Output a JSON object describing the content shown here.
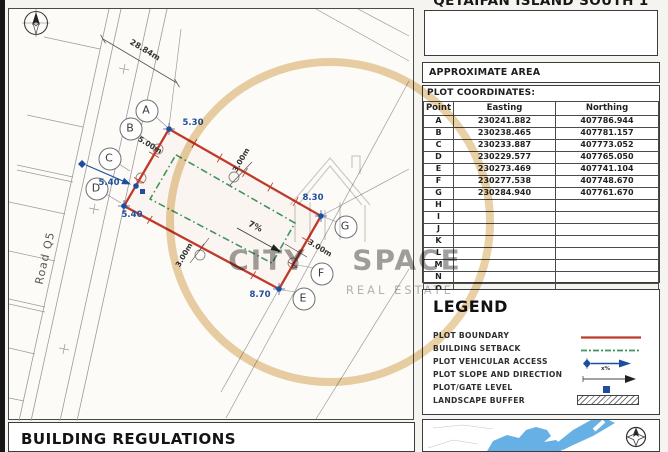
{
  "page": {
    "title": "QETAIFAN ISLAND SOUTH 1"
  },
  "area_box": {
    "label": "APPROXIMATE AREA"
  },
  "coordinates": {
    "label": "PLOT COORDINATES:",
    "columns": [
      "Point",
      "Easting",
      "Northing"
    ],
    "rows": [
      {
        "point": "A",
        "easting": "230241.882",
        "northing": "407786.944"
      },
      {
        "point": "B",
        "easting": "230238.465",
        "northing": "407781.157"
      },
      {
        "point": "C",
        "easting": "230233.887",
        "northing": "407773.052"
      },
      {
        "point": "D",
        "easting": "230229.577",
        "northing": "407765.050"
      },
      {
        "point": "E",
        "easting": "230273.469",
        "northing": "407741.104"
      },
      {
        "point": "F",
        "easting": "230277.538",
        "northing": "407748.670"
      },
      {
        "point": "G",
        "easting": "230284.940",
        "northing": "407761.670"
      },
      {
        "point": "H",
        "easting": "",
        "northing": ""
      },
      {
        "point": "I",
        "easting": "",
        "northing": ""
      },
      {
        "point": "J",
        "easting": "",
        "northing": ""
      },
      {
        "point": "K",
        "easting": "",
        "northing": ""
      },
      {
        "point": "L",
        "easting": "",
        "northing": ""
      },
      {
        "point": "M",
        "easting": "",
        "northing": ""
      },
      {
        "point": "N",
        "easting": "",
        "northing": ""
      },
      {
        "point": "O",
        "easting": "",
        "northing": ""
      }
    ]
  },
  "legend": {
    "title": "LEGEND",
    "items": [
      {
        "label": "PLOT BOUNDARY"
      },
      {
        "label": "BUILDING SETBACK"
      },
      {
        "label": "PLOT VEHICULAR ACCESS"
      },
      {
        "label": "PLOT SLOPE AND DIRECTION"
      },
      {
        "label": "PLOT/GATE LEVEL"
      },
      {
        "label": "LANDSCAPE BUFFER"
      }
    ],
    "slope_symbol_label": "x%"
  },
  "building_regulations": {
    "title": "BUILDING REGULATIONS"
  },
  "drawing": {
    "road_label": "Road Q5",
    "road_width_dim": "28.84m",
    "frontage_dim": "5.00m",
    "setback_dim_top": "3.00m",
    "setback_dim_bottom": "3.00m",
    "setback_dim_right": "3.00m",
    "slope_label": "7%",
    "levels": {
      "p1": "5.30",
      "p2": "8.30",
      "p3": "8.70",
      "p4": "5.40",
      "mid": "5.40"
    },
    "point_labels": [
      "A",
      "B",
      "C",
      "D",
      "E",
      "F",
      "G"
    ]
  },
  "watermark": {
    "line1": "CITY SPACE",
    "line2": "REAL ESTATE"
  },
  "colors": {
    "plot_boundary": "#bf3a2b",
    "building_setback": "#3f9460",
    "marker_blue": "#1f4e9e",
    "watermark_gold": "#e4c48e",
    "map_water": "#66b0e6"
  }
}
